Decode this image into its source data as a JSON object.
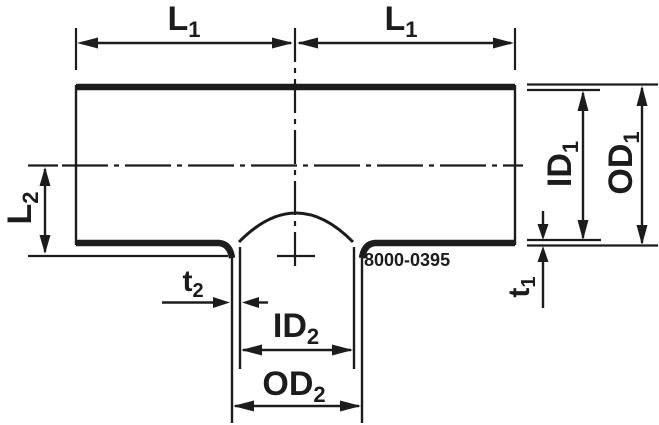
{
  "diagram": {
    "part_number": "8000-0395",
    "labels": {
      "l1_left": {
        "main": "L",
        "sub": "1"
      },
      "l1_right": {
        "main": "L",
        "sub": "1"
      },
      "l2": {
        "main": "L",
        "sub": "2"
      },
      "id1": {
        "main": "ID",
        "sub": "1"
      },
      "od1": {
        "main": "OD",
        "sub": "1"
      },
      "t1": {
        "main": "t",
        "sub": "1"
      },
      "t2": {
        "main": "t",
        "sub": "2"
      },
      "id2": {
        "main": "ID",
        "sub": "2"
      },
      "od2": {
        "main": "OD",
        "sub": "2"
      }
    },
    "colors": {
      "line": "#1c1c1c",
      "background": "#ffffff"
    }
  }
}
